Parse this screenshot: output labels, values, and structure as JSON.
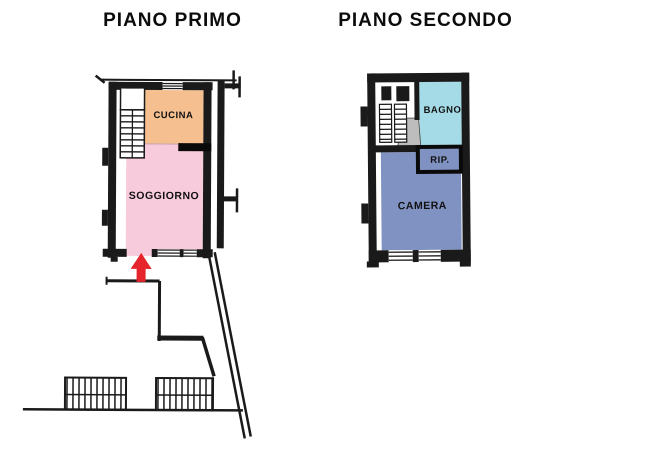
{
  "page": {
    "background": "#ffffff",
    "line_color": "#1a1a1a"
  },
  "floors": [
    {
      "id": "piano-primo",
      "title": "PIANO PRIMO",
      "rooms": [
        {
          "id": "cucina",
          "label": "CUCINA",
          "color": "#F5BF90"
        },
        {
          "id": "soggiorno",
          "label": "SOGGIORNO",
          "color": "#F8CBDC"
        }
      ],
      "entrance": {
        "icon": "arrow-up-icon",
        "color": "#E6242B"
      }
    },
    {
      "id": "piano-secondo",
      "title": "PIANO SECONDO",
      "rooms": [
        {
          "id": "bagno",
          "label": "BAGNO",
          "color": "#A5DBE7"
        },
        {
          "id": "rip",
          "label": "RIP.",
          "color": "#8092C2"
        },
        {
          "id": "camera",
          "label": "CAMERA",
          "color": "#8092C2"
        }
      ],
      "landing_color": "#BDBDBD"
    }
  ]
}
